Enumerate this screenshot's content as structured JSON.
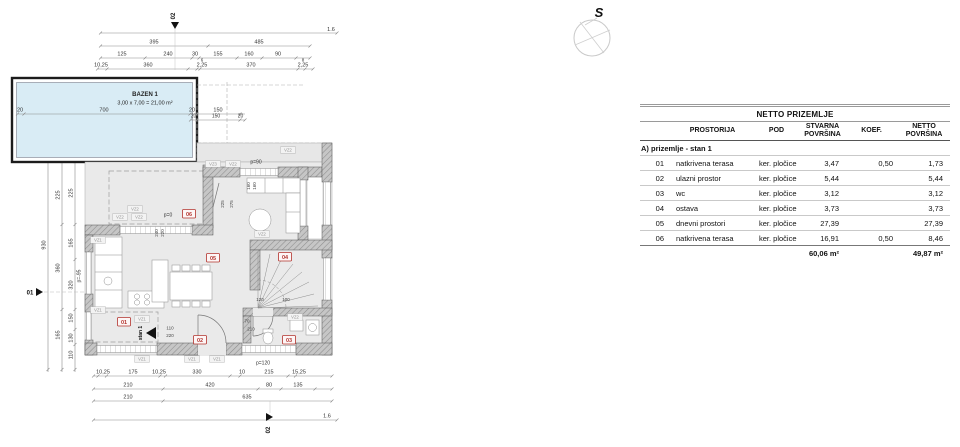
{
  "compass": {
    "label": "S"
  },
  "plan": {
    "pool": {
      "title": "BAZEN 1",
      "size": "3,00 x 7,00 = 21,00 m²"
    },
    "section_markers": {
      "top": "02",
      "bottom": "02",
      "left": "01"
    },
    "room_markers": {
      "r1": "01",
      "r2": "02",
      "r3": "03",
      "r4": "04",
      "r5": "05",
      "r6": "06"
    },
    "labels": {
      "stan": "stan 1",
      "p0": "p=0",
      "p90": "p=90",
      "p120": "p=120",
      "pm95": "p=-95",
      "vz1": "VZ1",
      "vz2": "VZ2",
      "vz3": "VZ3"
    },
    "dims": {
      "scale_top": "1.6",
      "scale_bottom": "1.6",
      "top1": [
        "395",
        "485"
      ],
      "top2": [
        "125",
        "240",
        "30",
        "155",
        "160",
        "90"
      ],
      "top3": [
        "10,25",
        "360",
        "2,25",
        "370",
        "2,25"
      ],
      "top3s": [
        "6",
        "8"
      ],
      "pool_w": [
        "20",
        "700",
        "20",
        "150"
      ],
      "pool_h": [
        "20",
        "300",
        "20"
      ],
      "roof": [
        "20",
        "150",
        "20"
      ],
      "left_total": "930",
      "left2": [
        "225",
        "360",
        "165"
      ],
      "left3": [
        "225",
        "165",
        "320",
        "150",
        "130",
        "110"
      ],
      "bottom1": [
        "10,25",
        "175",
        "10,25",
        "330",
        "10",
        "215",
        "15,25"
      ],
      "bottom2": [
        "210",
        "420",
        "80",
        "135"
      ],
      "bottom3": [
        "210",
        "635"
      ],
      "inner": [
        "225",
        "275",
        "240",
        "220",
        "160",
        "160",
        "110",
        "220",
        "120",
        "100",
        "70",
        "210"
      ]
    }
  },
  "table": {
    "title": "NETTO PRIZEMLJE",
    "headers": {
      "prostorija": "PROSTORIJA",
      "pod": "POD",
      "stvarna": "STVARNA POVRŠINA",
      "koef": "KOEF.",
      "netto": "NETTO POVRŠINA"
    },
    "section": "A) prizemlje - stan 1",
    "rows": [
      {
        "no": "01",
        "name": "natkrivena terasa",
        "pod": "ker. pločice",
        "stvarna": "3,47",
        "koef": "0,50",
        "netto": "1,73"
      },
      {
        "no": "02",
        "name": "ulazni prostor",
        "pod": "ker. pločice",
        "stvarna": "5,44",
        "koef": "",
        "netto": "5,44"
      },
      {
        "no": "03",
        "name": "wc",
        "pod": "ker. pločice",
        "stvarna": "3,12",
        "koef": "",
        "netto": "3,12"
      },
      {
        "no": "04",
        "name": "ostava",
        "pod": "ker. pločice",
        "stvarna": "3,73",
        "koef": "",
        "netto": "3,73"
      },
      {
        "no": "05",
        "name": "dnevni prostori",
        "pod": "ker. pločice",
        "stvarna": "27,39",
        "koef": "",
        "netto": "27,39"
      },
      {
        "no": "06",
        "name": "natkrivena terasa",
        "pod": "ker. pločice",
        "stvarna": "16,91",
        "koef": "0,50",
        "netto": "8,46"
      }
    ],
    "totals": {
      "stvarna": "60,06 m²",
      "netto": "49,87 m²"
    }
  }
}
